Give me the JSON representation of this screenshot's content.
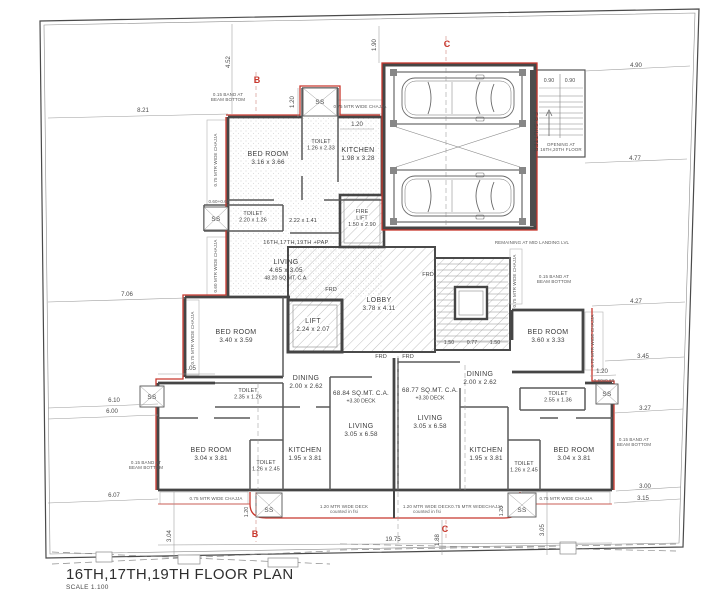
{
  "title": {
    "main": "16TH,17TH,19TH FLOOR PLAN",
    "scale": "SCALE 1.100"
  },
  "colors": {
    "accent_red": "#c8372d",
    "wall": "#454545",
    "hatch": "#a5a5a5",
    "dim_text": "#4a4a4a"
  },
  "labels": {
    "frd": "FRD",
    "ss": "SS"
  },
  "rooms": [
    {
      "name": "BED ROOM",
      "dims": "3.16 x 3.66",
      "x": 268,
      "y": 156
    },
    {
      "name": "TOILET",
      "dims": "1.26 x 2.33",
      "x": 321,
      "y": 143,
      "small": true
    },
    {
      "name": "KITCHEN",
      "dims": "1.98 x 3.28",
      "x": 358,
      "y": 152
    },
    {
      "name": "TOILET",
      "dims": "2.20 x 1.26",
      "x": 253,
      "y": 215,
      "small": true
    },
    {
      "name": "",
      "dims": "2.22 x 1.41",
      "x": 303,
      "y": 222,
      "small": true
    },
    {
      "name": "FIRE",
      "dims": "LIFT",
      "extra": "1.50 x 2.90",
      "x": 362,
      "y": 213,
      "small": true,
      "halo": true
    },
    {
      "name": "LIVING",
      "dims": "4.65 x 3.05",
      "extra": "48.20 SQ.MT. C.A.",
      "x": 286,
      "y": 264
    },
    {
      "name": "LOBBY",
      "dims": "3.78 x 4.11",
      "x": 379,
      "y": 302,
      "halo": true
    },
    {
      "name": "LIFT",
      "dims": "2.24 x 2.07",
      "x": 313,
      "y": 323,
      "halo": true
    },
    {
      "name": "BED ROOM",
      "dims": "3.40 x 3.59",
      "x": 236,
      "y": 334
    },
    {
      "name": "BED ROOM",
      "dims": "3.60 x 3.33",
      "x": 548,
      "y": 334
    },
    {
      "name": "TOILET",
      "dims": "2.35 x 1.26",
      "x": 248,
      "y": 392,
      "small": true
    },
    {
      "name": "TOILET",
      "dims": "2.55 x 1.36",
      "x": 558,
      "y": 395,
      "small": true
    },
    {
      "name": "DINING",
      "dims": "2.00 x 2.62",
      "x": 306,
      "y": 380
    },
    {
      "name": "DINING",
      "dims": "2.00 x 2.62",
      "x": 480,
      "y": 376
    },
    {
      "name": "",
      "dims": "68.84 SQ.MT. C.A.",
      "extra": "+3.30 DECK",
      "x": 361,
      "y": 395
    },
    {
      "name": "",
      "dims": "68.77 SQ.MT. C.A.",
      "extra": "+3.30 DECK",
      "x": 430,
      "y": 392
    },
    {
      "name": "LIVING",
      "dims": "3.05 x 6.58",
      "x": 361,
      "y": 428
    },
    {
      "name": "LIVING",
      "dims": "3.05 x 6.58",
      "x": 430,
      "y": 420
    },
    {
      "name": "KITCHEN",
      "dims": "1.95 x 3.81",
      "x": 305,
      "y": 452
    },
    {
      "name": "KITCHEN",
      "dims": "1.95 x 3.81",
      "x": 486,
      "y": 452
    },
    {
      "name": "BED ROOM",
      "dims": "3.04 x 3.81",
      "x": 211,
      "y": 452
    },
    {
      "name": "BED ROOM",
      "dims": "3.04 x 3.81",
      "x": 574,
      "y": 452
    },
    {
      "name": "TOILET",
      "dims": "1.26 x 2.45",
      "x": 266,
      "y": 464,
      "small": true
    },
    {
      "name": "TOILET",
      "dims": "1.26 x 2.45",
      "x": 524,
      "y": 465,
      "small": true
    }
  ],
  "dimensions": [
    {
      "t": "8.21",
      "x": 143,
      "y": 112
    },
    {
      "t": "4.52",
      "x": 230,
      "y": 62,
      "rot": -90
    },
    {
      "t": "1.20",
      "x": 294,
      "y": 102,
      "rot": -90
    },
    {
      "t": "1.90",
      "x": 376,
      "y": 45,
      "rot": -90
    },
    {
      "t": "4.90",
      "x": 636,
      "y": 67
    },
    {
      "t": "0.90",
      "x": 549,
      "y": 82,
      "sm": true
    },
    {
      "t": "0.90",
      "x": 570,
      "y": 82,
      "sm": true
    },
    {
      "t": "4.77",
      "x": 635,
      "y": 160
    },
    {
      "t": "7.06",
      "x": 127,
      "y": 296
    },
    {
      "t": "1.20",
      "x": 357,
      "y": 126
    },
    {
      "t": "4.27",
      "x": 636,
      "y": 303
    },
    {
      "t": "3.45",
      "x": 643,
      "y": 358
    },
    {
      "t": "1.20",
      "x": 602,
      "y": 373
    },
    {
      "t": "3.27",
      "x": 645,
      "y": 410
    },
    {
      "t": "6.10",
      "x": 114,
      "y": 402
    },
    {
      "t": "6.00",
      "x": 112,
      "y": 413
    },
    {
      "t": "1.05",
      "x": 190,
      "y": 370
    },
    {
      "t": "3.00",
      "x": 645,
      "y": 488
    },
    {
      "t": "3.15",
      "x": 643,
      "y": 500
    },
    {
      "t": "6.07",
      "x": 114,
      "y": 497
    },
    {
      "t": "3.04",
      "x": 171,
      "y": 536,
      "rot": -90
    },
    {
      "t": "3.05",
      "x": 544,
      "y": 530,
      "rot": -90
    },
    {
      "t": "1.88",
      "x": 439,
      "y": 540,
      "rot": -90
    },
    {
      "t": "19.75",
      "x": 393,
      "y": 541
    },
    {
      "t": "1.50",
      "x": 449,
      "y": 344,
      "sm": true
    },
    {
      "t": "0.77",
      "x": 472,
      "y": 344,
      "sm": true
    },
    {
      "t": "1.50",
      "x": 495,
      "y": 344,
      "sm": true
    },
    {
      "t": "1.20",
      "x": 248,
      "y": 512,
      "rot": -90,
      "sm": true
    },
    {
      "t": "1.20",
      "x": 503,
      "y": 511,
      "rot": -90,
      "sm": true
    }
  ],
  "annotations": [
    {
      "t": "0.75 MTR WIDE CHAJJA",
      "x": 217,
      "y": 160,
      "rot": -90
    },
    {
      "t": "0.60 MTR WIDE CHAJJA",
      "x": 217,
      "y": 266,
      "rot": -90
    },
    {
      "t": "0.75 MTR WIDE CHAJJA",
      "x": 194,
      "y": 338,
      "rot": -90
    },
    {
      "t": "0.75 MTR WIDE CHAJJA",
      "x": 594,
      "y": 341,
      "rot": -90
    },
    {
      "t": "0.75 MTR WIDE CHAJJA",
      "x": 516,
      "y": 281,
      "rot": -90
    },
    {
      "t": "0.75 MTR WIDE CHAJJA",
      "x": 360,
      "y": 108
    },
    {
      "t": "0.75 MTR WIDE CHAJJA",
      "x": 216,
      "y": 500
    },
    {
      "t": "0.75 MTR WIDECHAJJA",
      "x": 477,
      "y": 508
    },
    {
      "t": "0.75 MTR WIDE CHAJJA",
      "x": 566,
      "y": 500
    },
    {
      "t": "1.20 MTR WIDE DECK",
      "t2": "counted in fsi",
      "x": 344,
      "y": 508
    },
    {
      "t": "1.20 MTR WIDE DECK",
      "t2": "counted in fsi",
      "x": 427,
      "y": 508
    },
    {
      "t": "0.15 BAND AT",
      "t2": "BEAM BOTTOM",
      "x": 228,
      "y": 96
    },
    {
      "t": "0.15 BAND AT",
      "t2": "BEAM BOTTOM",
      "x": 146,
      "y": 464
    },
    {
      "t": "0.15 BAND AT",
      "t2": "BEAM BOTTOM",
      "x": 554,
      "y": 278
    },
    {
      "t": "0.15 BAND AT",
      "t2": "BEAM BOTTOM",
      "x": 634,
      "y": 441
    },
    {
      "t": "REMAINING AT MID LANDING LVL",
      "x": 532,
      "y": 244
    },
    {
      "t": "OPENING AT",
      "t2": "16TH,20TH FLOOR",
      "x": 561,
      "y": 146
    },
    {
      "t": "F.R.SHUTTER",
      "x": 534,
      "y": 132,
      "rot": 90,
      "big": true
    },
    {
      "t": "16TH,17TH,19TH +PAP",
      "x": 296,
      "y": 244,
      "big": true
    },
    {
      "t": "0.60+0.60",
      "x": 219,
      "y": 203
    },
    {
      "t": "0.60x0.60",
      "x": 604,
      "y": 382
    }
  ],
  "frd_positions": [
    {
      "x": 331,
      "y": 291
    },
    {
      "x": 428,
      "y": 276
    },
    {
      "x": 381,
      "y": 358
    },
    {
      "x": 408,
      "y": 358
    }
  ],
  "ss_positions": [
    {
      "x": 320,
      "y": 104
    },
    {
      "x": 216,
      "y": 221
    },
    {
      "x": 152,
      "y": 399
    },
    {
      "x": 607,
      "y": 396
    },
    {
      "x": 269,
      "y": 512
    },
    {
      "x": 522,
      "y": 512
    }
  ],
  "markers": [
    {
      "t": "B",
      "x": 257,
      "y": 83
    },
    {
      "t": "C",
      "x": 447,
      "y": 47
    },
    {
      "t": "B",
      "x": 255,
      "y": 537
    },
    {
      "t": "C",
      "x": 445,
      "y": 532
    }
  ]
}
